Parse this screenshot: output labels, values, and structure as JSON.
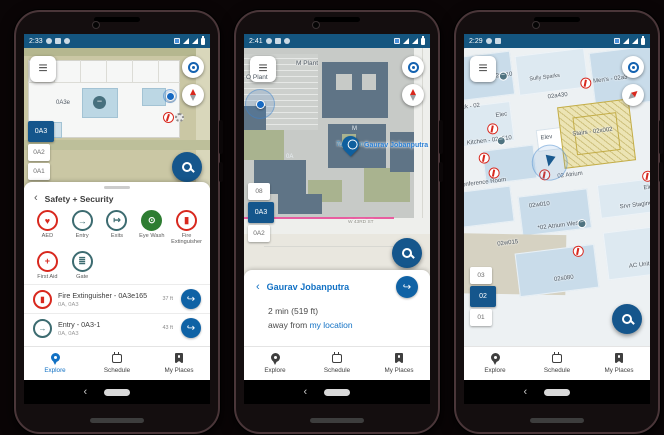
{
  "theme": {
    "status_bar": "#14557f",
    "accent_blue": "#15568c",
    "link_blue": "#1271c4",
    "safety_red": "#d8281e",
    "safety_teal": "#3c6b70",
    "safety_green": "#2e7d32",
    "map_tan": "#cac7a4",
    "map_gray": "#c7cac7",
    "building_slate": "#5f7486",
    "room_blue": "#c9dcea",
    "stairs_yellow": "#ece4b4"
  },
  "icons": {
    "menu-icon": "≡",
    "locate-icon": "target",
    "compass-icon": "needle",
    "search-icon": "magnifier",
    "directions-icon": "↪",
    "back-icon": "‹",
    "explore-icon": "map-pin",
    "schedule-icon": "calendar",
    "my-places-icon": "bookmark",
    "elevator-icon": "−",
    "safety-icon": "fire-extinguisher"
  },
  "phones": [
    {
      "status": {
        "time": "2:33"
      },
      "map": {
        "wing_label": "0A3e",
        "floors": [
          {
            "label": "0A3"
          },
          {
            "label": "0A2"
          },
          {
            "label": "0A1"
          }
        ]
      },
      "sheet": {
        "back": "‹",
        "title": "Safety + Security",
        "categories": [
          {
            "label": "AED",
            "glyph": "♥",
            "color": "#d8281e"
          },
          {
            "label": "Entry",
            "glyph": "→",
            "color": "#3c6b70"
          },
          {
            "label": "Exits",
            "glyph": "↦",
            "color": "#3c6b70"
          },
          {
            "label": "Eye Wash",
            "glyph": "⊙",
            "color": "#2e7d32"
          },
          {
            "label": "Fire Extinguisher",
            "glyph": "▮",
            "color": "#d8281e"
          },
          {
            "label": "First Aid",
            "glyph": "+",
            "color": "#d8281e"
          },
          {
            "label": "Gate",
            "glyph": "≣",
            "color": "#3c6b70"
          }
        ],
        "results": [
          {
            "title": "Fire Extinguisher - 0A3e165",
            "subtitle": "0A, 0A3",
            "distance": "37 ft",
            "glyph": "▮"
          },
          {
            "title": "Entry - 0A3-1",
            "subtitle": "0A, 0A3",
            "distance": "43 ft",
            "glyph": "→"
          }
        ]
      },
      "nav": {
        "explore": "Explore",
        "schedule": "Schedule",
        "places": "My Places"
      }
    },
    {
      "status": {
        "time": "2:41"
      },
      "map": {
        "labels": {
          "plant_m": "M Plant",
          "plant_o": "O Plant",
          "bldg_m": "M",
          "pond": "Turtle Pon",
          "wing": "0A",
          "street": "W 43RD ST"
        },
        "pin_label": "Gaurav Jobanputra",
        "floors": [
          {
            "label": "08"
          },
          {
            "label": "0A3"
          },
          {
            "label": "0A2"
          }
        ]
      },
      "sheet": {
        "back": "‹",
        "title": "Gaurav Jobanputra",
        "eta": "2 min (519 ft)",
        "away_prefix": "away from ",
        "away_link": "my location"
      },
      "nav": {
        "explore": "Explore",
        "schedule": "Schedule",
        "places": "My Places"
      }
    },
    {
      "status": {
        "time": "2:29"
      },
      "map": {
        "labels": [
          "02n020",
          "*02 North A Conference Room",
          "Print - 02n010",
          "Sully Sparks",
          "Men's - 02a3",
          "Deck - 02",
          "Elec",
          "02a430",
          "Kitchen - 02a510",
          "Elev",
          "Stairs - 02x002",
          "02 Atrium",
          "Conference Room",
          "02w010",
          "*02 Atrium West",
          "02w015",
          "Srvr Staging",
          "02s080",
          "AC Unit",
          "Elec"
        ],
        "floors": [
          {
            "label": "03"
          },
          {
            "label": "02"
          },
          {
            "label": "01"
          }
        ]
      },
      "nav": {
        "explore": "Explore",
        "schedule": "Schedule",
        "places": "My Places"
      }
    }
  ]
}
